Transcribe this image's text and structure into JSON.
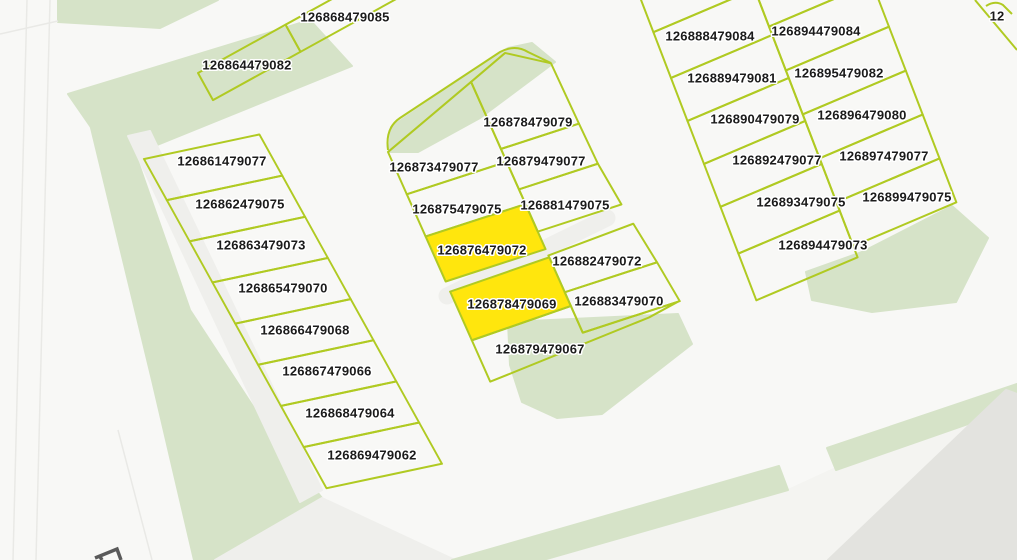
{
  "title": "Cadastral parcel map view",
  "colors": {
    "background": "#f8f8f6",
    "green": "#d6e3c8",
    "road": "#efefec",
    "road_light": "#f4f4f1",
    "road_dark": "#e3e3df",
    "parcel_line": "#b0ca22",
    "highlight_fill": "#ffe60d",
    "label_text": "#1b1b1b",
    "label_halo": "#ffffff",
    "edge_line": "#e9e9e6",
    "glyph": "#5a5a5a"
  },
  "map": {
    "highlighted": [
      "126876479072",
      "126878479069"
    ],
    "areas": [
      {
        "name": "green-strip-top-left",
        "kind": "green",
        "points": "58,0 218,0 160,28 58,22"
      },
      {
        "name": "green-band-upper",
        "kind": "green",
        "points": "68,94 310,20 352,66 115,162"
      },
      {
        "name": "green-band-left",
        "kind": "green",
        "points": "85,103 128,133 190,310 275,440 322,498 213,560 194,560 152,380"
      },
      {
        "name": "road-band-left",
        "kind": "road",
        "points": "128,136 150,131 322,490 300,502"
      },
      {
        "name": "road-notch-bottom-left",
        "kind": "road",
        "points": "215,560 322,498 455,560"
      },
      {
        "name": "green-corner-middle-block",
        "kind": "green",
        "points": "389,152 391,127 508,48 532,43 555,62 480,118 418,152"
      },
      {
        "name": "green-middle-block-bottom",
        "kind": "green",
        "points": "508,322 678,314 692,344 602,414 557,418 522,402 510,365"
      },
      {
        "name": "green-right-block-bottom",
        "kind": "green",
        "points": "806,272 862,252 952,206 988,238 956,302 872,312 812,300"
      },
      {
        "name": "road-bottom-right",
        "kind": "road_light",
        "points": "543,560 788,490 1006,390 1017,394 1017,560"
      },
      {
        "name": "green-verge-bottom-1",
        "kind": "green",
        "points": "452,560 779,466 788,490 543,560"
      },
      {
        "name": "green-verge-bottom-2",
        "kind": "green",
        "points": "827,448 1017,384 1017,407 836,470"
      },
      {
        "name": "gray-area-bottom-corner",
        "kind": "road_dark",
        "points": "1006,390 1017,394 1017,560 828,560"
      }
    ],
    "lines": [
      {
        "name": "road-edge-far-left-1",
        "kind": "edge",
        "x1": 27,
        "y1": 0,
        "x2": 13,
        "y2": 560,
        "w": 1.5
      },
      {
        "name": "road-edge-far-left-2",
        "kind": "edge",
        "x1": 50,
        "y1": 0,
        "x2": 36,
        "y2": 560,
        "w": 1.5
      },
      {
        "name": "road-edge-top-left",
        "kind": "edge",
        "x1": 0,
        "y1": 34,
        "x2": 58,
        "y2": 21,
        "w": 1.5
      },
      {
        "name": "road-edge-bottom-left",
        "kind": "edge",
        "x1": 118,
        "y1": 430,
        "x2": 152,
        "y2": 560,
        "w": 1.5
      },
      {
        "name": "street-culdesac-middle",
        "kind": "road",
        "x1": 447,
        "y1": 296,
        "x2": 607,
        "y2": 218,
        "w": 17,
        "cap": "round"
      }
    ],
    "blocks": [
      {
        "name": "top-row-block",
        "transform": "translate(198,73) rotate(-28.9)",
        "parcels": [
          {
            "id": "126864479082",
            "shape": {
              "x": 0,
              "y": 0,
              "w": 100,
              "h": 31
            }
          },
          {
            "id": "126868479085",
            "shape": {
              "x": 100,
              "y": 0,
              "w": 160,
              "h": 31
            }
          }
        ]
      },
      {
        "name": "left-strip-block",
        "transform": "translate(144,159) rotate(-12) skewX(17)",
        "parcels": [
          {
            "id": "126861479077",
            "shape": {
              "x": 0,
              "y": 0,
              "w": 118,
              "h": 45
            }
          },
          {
            "id": "126862479075",
            "shape": {
              "x": 0,
              "y": 45,
              "w": 118,
              "h": 45
            }
          },
          {
            "id": "126863479073",
            "shape": {
              "x": 0,
              "y": 90,
              "w": 118,
              "h": 45
            }
          },
          {
            "id": "126865479070",
            "shape": {
              "x": 0,
              "y": 135,
              "w": 118,
              "h": 45
            }
          },
          {
            "id": "126866479068",
            "shape": {
              "x": 0,
              "y": 180,
              "w": 118,
              "h": 45
            }
          },
          {
            "id": "126867479066",
            "shape": {
              "x": 0,
              "y": 225,
              "w": 118,
              "h": 45
            }
          },
          {
            "id": "126868479064",
            "shape": {
              "x": 0,
              "y": 270,
              "w": 118,
              "h": 45
            }
          },
          {
            "id": "126869479062",
            "shape": {
              "x": 0,
              "y": 315,
              "w": 118,
              "h": 45
            }
          }
        ]
      },
      {
        "name": "middle-block",
        "transform": "translate(388,152) rotate(-18) skewX(6)",
        "parcels": [
          {
            "id": "126873479077",
            "shape": {
              "points": "0,0 105,-41 105,46 0,46"
            }
          },
          {
            "id": "126878479079",
            "shape": {
              "points": "105,-41 148,-58 186,-34 187,32 105,32"
            }
          },
          {
            "id": "126875479075",
            "shape": {
              "x": 0,
              "y": 46,
              "w": 105,
              "h": 46
            }
          },
          {
            "id": "126879479077",
            "shape": {
              "points": "105,32 187,32 188,76 105,76"
            }
          },
          {
            "id": "126876479072",
            "shape": {
              "x": 0,
              "y": 92,
              "w": 105,
              "h": 49
            }
          },
          {
            "id": "126881479075",
            "shape": {
              "points": "105,76 188,76 193,122 105,122"
            }
          },
          {
            "id": "126882479072",
            "shape": {
              "points": "105,148 196,144 202,188 105,188"
            }
          },
          {
            "id": "126878479069",
            "shape": {
              "points": "0,152 105,150 105,203 0,205"
            }
          },
          {
            "id": "126883479070",
            "shape": {
              "points": "105,188 202,188 207,232 105,232"
            }
          },
          {
            "id": "126879479067",
            "shape": {
              "points": "0,205 105,203 105,232 205,232 172,238 30,248 0,250"
            }
          }
        ]
      },
      {
        "name": "right-block",
        "transform": "translate(635,40) rotate(-23) skewX(-2)",
        "parcels": [
          {
            "id": "",
            "shape": {
              "x": 20,
              "y": -50,
              "w": 110,
              "h": 50
            }
          },
          {
            "id": "126888479084",
            "shape": {
              "x": 20,
              "y": 0,
              "w": 110,
              "h": 49
            }
          },
          {
            "id": "126889479081",
            "shape": {
              "x": 20,
              "y": 49,
              "w": 110,
              "h": 46
            }
          },
          {
            "id": "126890479079",
            "shape": {
              "x": 20,
              "y": 95,
              "w": 110,
              "h": 46
            }
          },
          {
            "id": "126892479077",
            "shape": {
              "x": 20,
              "y": 141,
              "w": 110,
              "h": 46
            }
          },
          {
            "id": "126893479075",
            "shape": {
              "x": 20,
              "y": 187,
              "w": 110,
              "h": 50
            }
          },
          {
            "id": "126894479073",
            "shape": {
              "x": 20,
              "y": 237,
              "w": 110,
              "h": 50
            }
          },
          {
            "id": "",
            "shape": {
              "x": 130,
              "y": -30,
              "w": 112,
              "h": 70
            }
          },
          {
            "id": "126894479084",
            "shape": {
              "x": 130,
              "y": 40,
              "w": 112,
              "h": 47
            }
          },
          {
            "id": "126895479082",
            "shape": {
              "x": 130,
              "y": 87,
              "w": 112,
              "h": 47
            }
          },
          {
            "id": "126896479080",
            "shape": {
              "x": 130,
              "y": 134,
              "w": 112,
              "h": 47
            }
          },
          {
            "id": "126897479077",
            "shape": {
              "x": 130,
              "y": 181,
              "w": 112,
              "h": 47
            }
          },
          {
            "id": "126899479075",
            "shape": {
              "x": 130,
              "y": 228,
              "w": 112,
              "h": 47
            }
          }
        ]
      }
    ],
    "stray_paths": [
      {
        "name": "middle-block-outline-top",
        "d": "M388,150 Q385,128 400,118 L500,52 Q515,44 528,52 L551,63"
      },
      {
        "name": "partial-parcel-top-right-1",
        "d": "M975,0 L1017,50"
      },
      {
        "name": "partial-parcel-top-right-2",
        "d": "M986,6 Q995,0 1003,5 L1012,14"
      }
    ],
    "labels": [
      {
        "text": "126868479085",
        "x": 345,
        "y": 17
      },
      {
        "text": "126864479082",
        "x": 247,
        "y": 65
      },
      {
        "text": "126861479077",
        "x": 222,
        "y": 161
      },
      {
        "text": "126862479075",
        "x": 240,
        "y": 204
      },
      {
        "text": "126863479073",
        "x": 261,
        "y": 245
      },
      {
        "text": "126865479070",
        "x": 283,
        "y": 288
      },
      {
        "text": "126866479068",
        "x": 305,
        "y": 330
      },
      {
        "text": "126867479066",
        "x": 327,
        "y": 371
      },
      {
        "text": "126868479064",
        "x": 350,
        "y": 413
      },
      {
        "text": "126869479062",
        "x": 372,
        "y": 455
      },
      {
        "text": "126878479079",
        "x": 528,
        "y": 122
      },
      {
        "text": "126873479077",
        "x": 434,
        "y": 167
      },
      {
        "text": "126879479077",
        "x": 541,
        "y": 161
      },
      {
        "text": "126875479075",
        "x": 457,
        "y": 209
      },
      {
        "text": "126881479075",
        "x": 565,
        "y": 205
      },
      {
        "text": "126876479072",
        "x": 482,
        "y": 250
      },
      {
        "text": "126882479072",
        "x": 597,
        "y": 261
      },
      {
        "text": "126878479069",
        "x": 512,
        "y": 304
      },
      {
        "text": "126883479070",
        "x": 619,
        "y": 301
      },
      {
        "text": "126879479067",
        "x": 540,
        "y": 349
      },
      {
        "text": "126888479084",
        "x": 710,
        "y": 36
      },
      {
        "text": "126894479084",
        "x": 816,
        "y": 31
      },
      {
        "text": "126889479081",
        "x": 732,
        "y": 78
      },
      {
        "text": "126895479082",
        "x": 839,
        "y": 73
      },
      {
        "text": "126890479079",
        "x": 755,
        "y": 119
      },
      {
        "text": "126896479080",
        "x": 862,
        "y": 115
      },
      {
        "text": "126892479077",
        "x": 777,
        "y": 160
      },
      {
        "text": "126897479077",
        "x": 884,
        "y": 156
      },
      {
        "text": "126893479075",
        "x": 801,
        "y": 202
      },
      {
        "text": "126899479075",
        "x": 907,
        "y": 197
      },
      {
        "text": "126894479073",
        "x": 823,
        "y": 245
      },
      {
        "text": "12",
        "x": 997,
        "y": 16
      }
    ],
    "glyph": {
      "name": "partial-map-glyph",
      "d": "M95,558 L117,549 L121,560 M99,555 L102,560"
    }
  }
}
